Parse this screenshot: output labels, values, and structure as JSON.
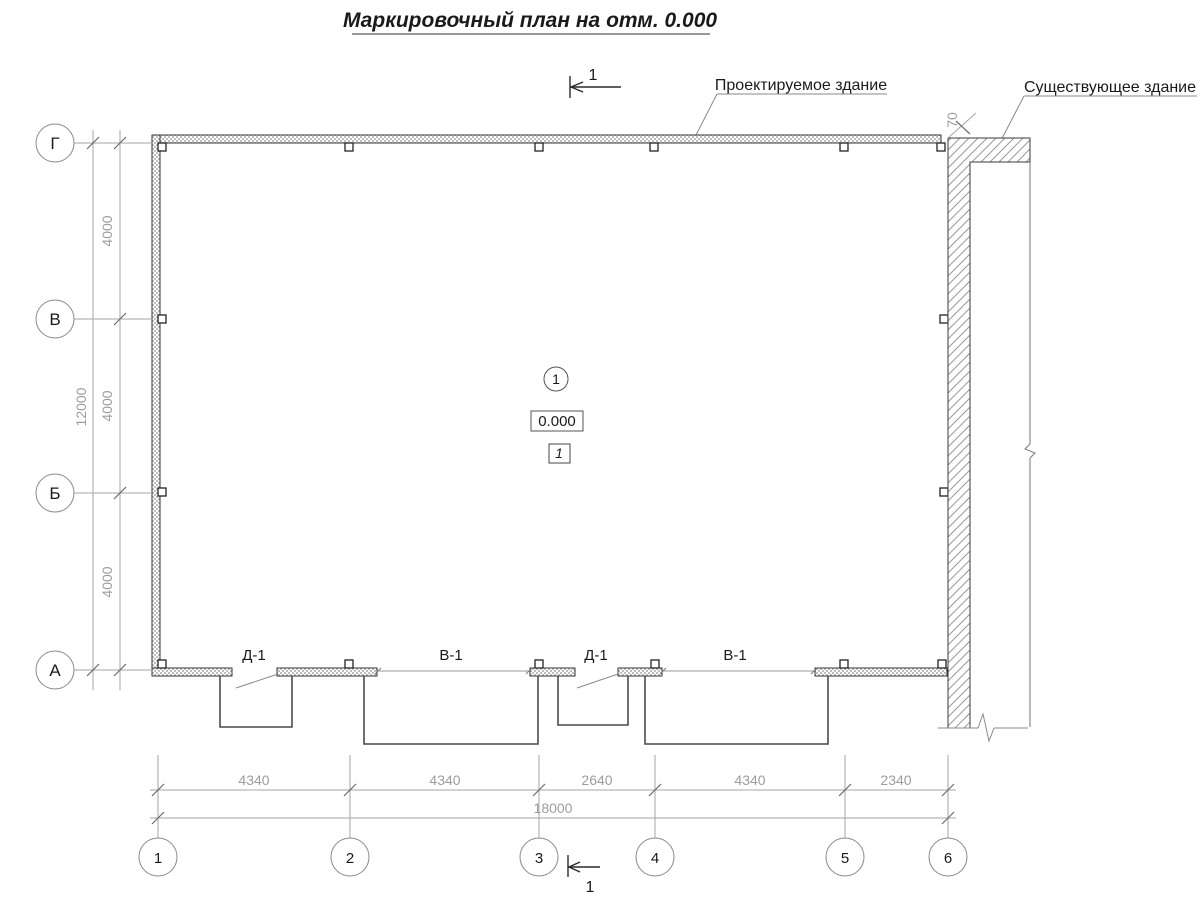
{
  "title": "Маркировочный план на отм. 0.000",
  "callouts": {
    "designed_building": "Проектируемое здание",
    "existing_building": "Существующее здание"
  },
  "section_marks": {
    "top_label": "1",
    "bottom_label": "1"
  },
  "center_marks": {
    "axis_node": "1",
    "elevation": "0.000",
    "room_number": "1"
  },
  "openings": {
    "labels": [
      "Д-1",
      "В-1",
      "Д-1",
      "В-1"
    ]
  },
  "axes": {
    "rows": [
      "Г",
      "В",
      "Б",
      "А"
    ],
    "columns": [
      "1",
      "2",
      "3",
      "4",
      "5",
      "6"
    ]
  },
  "dimensions": {
    "left_segments": [
      "4000",
      "4000",
      "4000"
    ],
    "left_total": "12000",
    "bottom_segments": [
      "4340",
      "4340",
      "2640",
      "4340",
      "2340"
    ],
    "bottom_total": "18000",
    "wall_gap": "70"
  },
  "colors": {
    "line_dark": "#2a2a2a",
    "line_light": "#a6a6a6",
    "dim_text": "#9c9c9c",
    "hatch": "#9a9a9a"
  }
}
